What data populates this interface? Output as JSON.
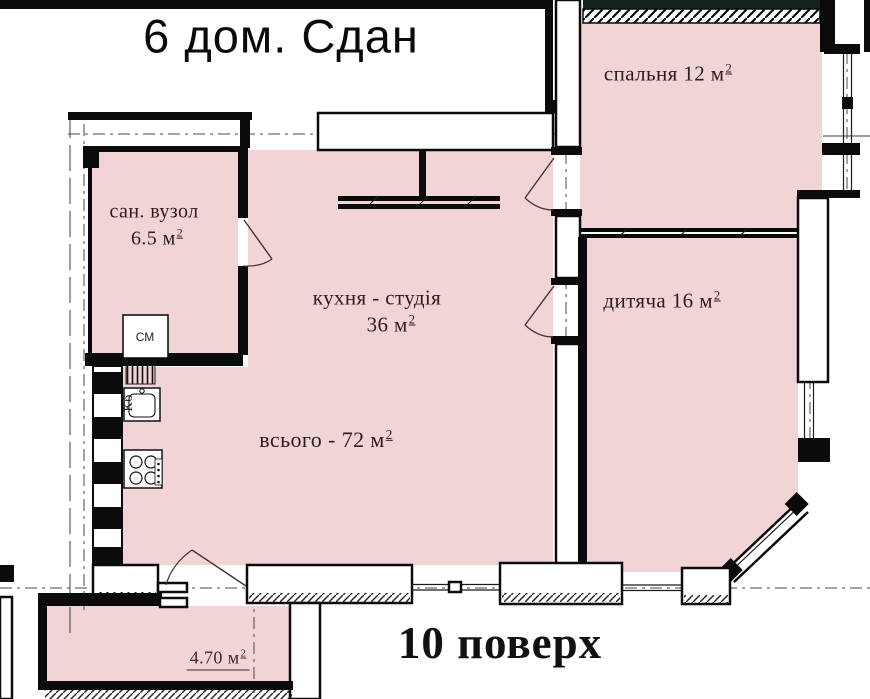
{
  "title": "6 дом. Сдан",
  "floor_label": "10 поверх",
  "rooms": {
    "bathroom": {
      "name": "сан. вузол",
      "area": "6.5 м",
      "sup": "2"
    },
    "kitchen": {
      "name": "кухня - студія",
      "area": "36 м",
      "sup": "2"
    },
    "total": {
      "label": "всього - 72 м",
      "sup": "2"
    },
    "bedroom": {
      "label": "спальня 12 м",
      "sup": "2"
    },
    "kids_room": {
      "label": "дитяча 16 м",
      "sup": "2"
    },
    "balcony": {
      "label": "4.70 м",
      "sup": "2"
    }
  },
  "appliances": {
    "washing_machine": "СМ",
    "sink": "Кб"
  },
  "colors": {
    "room_fill": "#f1d4d6",
    "wall": "#0b0b0b",
    "top_strip": "#16251b"
  }
}
